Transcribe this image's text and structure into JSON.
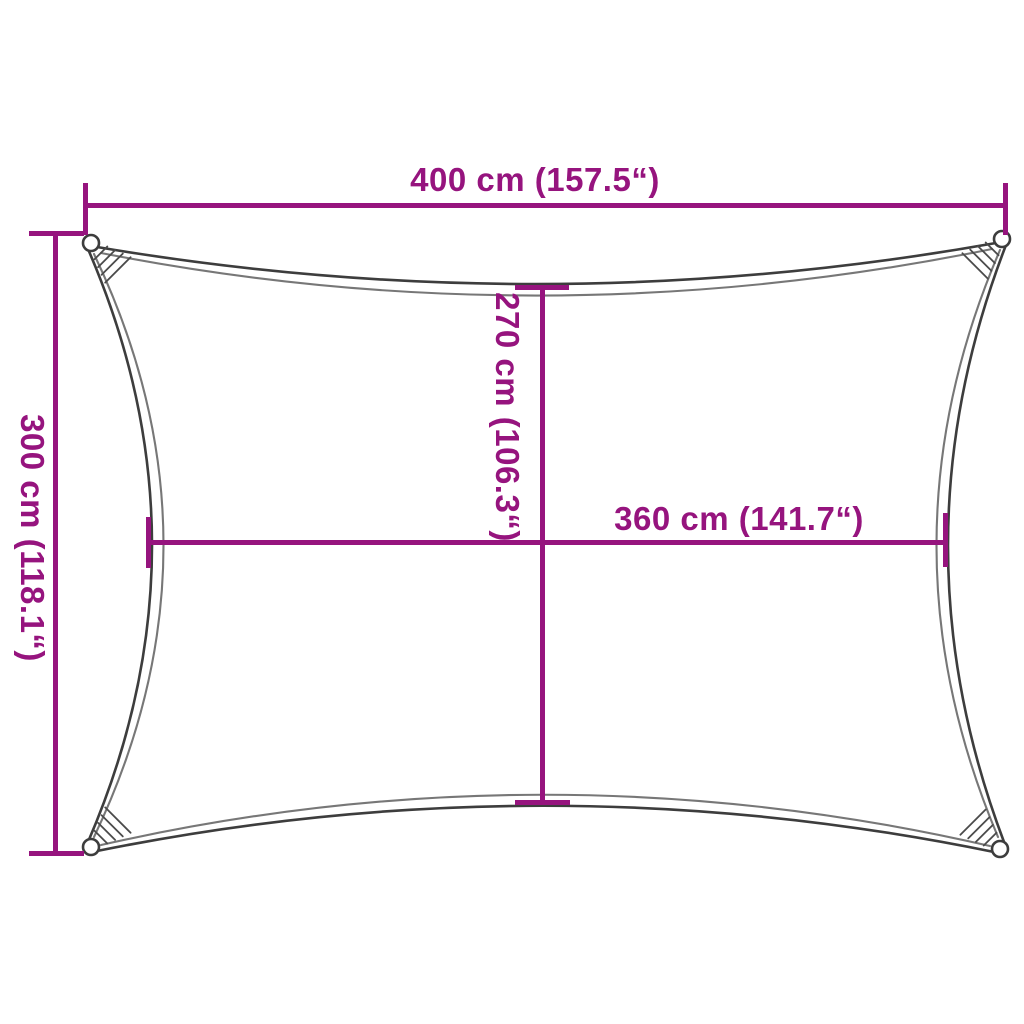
{
  "diagram": {
    "labels": {
      "width_top": "400 cm (157.5“)",
      "height_left": "300 cm (118.1“)",
      "height_inner": "270 cm (106.3“)",
      "width_inner": "360 cm (141.7“)"
    },
    "values": {
      "width_cm": 400,
      "width_inch": 157.5,
      "height_cm": 300,
      "height_inch": 118.1,
      "inner_height_cm": 270,
      "inner_height_inch": 106.3,
      "inner_width_cm": 360,
      "inner_width_inch": 141.7
    },
    "colors": {
      "dimension": "#96147E",
      "outline": "#3D3D3D",
      "outline_inner": "#777777",
      "background": "#FFFFFF"
    }
  }
}
